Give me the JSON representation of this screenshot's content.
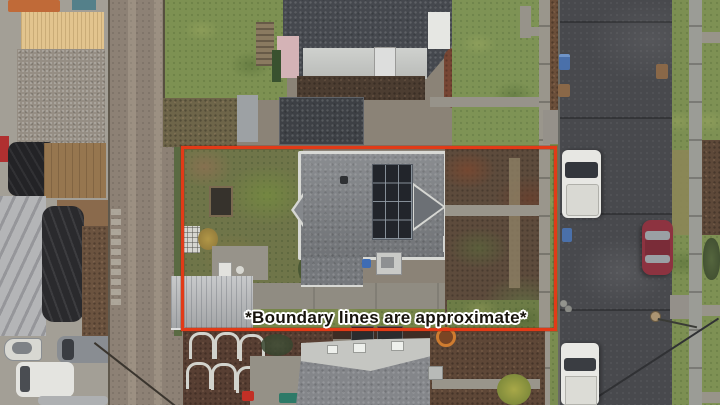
{
  "annotation": {
    "caption": "*Boundary lines are approximate*",
    "boundary_color": "#e23a17",
    "caption_color": "#17130c",
    "caption_outline_color": "#ffffff"
  },
  "scene": {
    "view": "aerial top-down photo of residential lot",
    "property": {
      "roof_color": "#7d8084",
      "solar_array": {
        "columns": 3,
        "rows": 4,
        "panel_color": "#22252b"
      },
      "carport_color": "#b6b8ba"
    },
    "street": {
      "asphalt_color": "#48494d",
      "sidewalk_color": "#9a9b95",
      "truck_color": "#e7e7e3",
      "sedan_color": "#8d3340",
      "bin_color": "#4a70aa"
    },
    "ground": {
      "grass_color": "#7d9152",
      "mulch_color": "#5a4336",
      "alley_color": "#8d8175"
    }
  }
}
